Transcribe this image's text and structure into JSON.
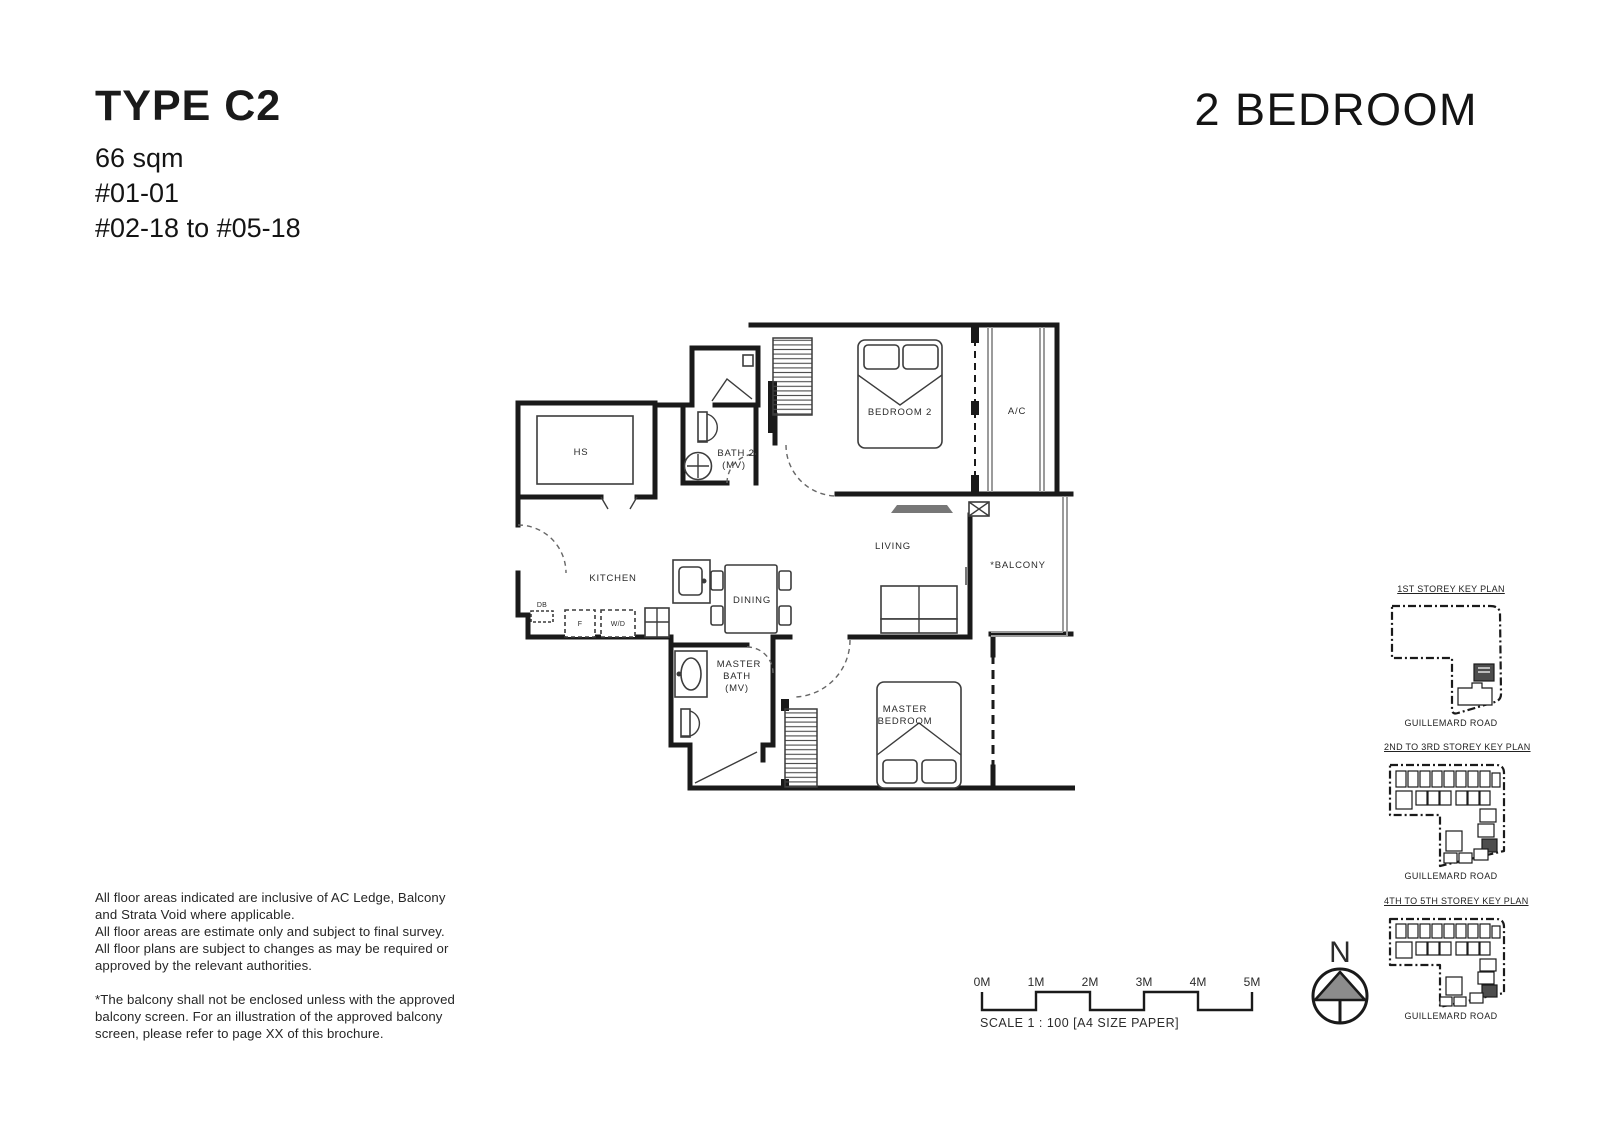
{
  "header": {
    "type_name": "TYPE C2",
    "area": "66 sqm",
    "units": [
      "#01-01",
      "#02-18 to #05-18"
    ],
    "category": "2 BEDROOM"
  },
  "plan": {
    "labels": {
      "hs": "HS",
      "bath2_l1": "BATH 2",
      "bath2_l2": "(MV)",
      "bedroom2": "BEDROOM 2",
      "ac": "A/C",
      "living": "LIVING",
      "balcony": "*BALCONY",
      "kitchen": "KITCHEN",
      "dining": "DINING",
      "mbath_l1": "MASTER",
      "mbath_l2": "BATH",
      "mbath_l3": "(MV)",
      "mbed_l1": "MASTER",
      "mbed_l2": "BEDROOM",
      "db": "DB",
      "f": "F",
      "wd": "W/D"
    }
  },
  "keyplans": [
    {
      "title": "1ST STOREY KEY PLAN",
      "caption": "GUILLEMARD ROAD"
    },
    {
      "title": "2ND TO 3RD STOREY KEY PLAN",
      "caption": "GUILLEMARD ROAD"
    },
    {
      "title": "4TH TO 5TH STOREY KEY PLAN",
      "caption": "GUILLEMARD ROAD"
    }
  ],
  "scale": {
    "ticks": [
      "0M",
      "1M",
      "2M",
      "3M",
      "4M",
      "5M"
    ],
    "caption": "SCALE  1 : 100 [A4 SIZE PAPER]"
  },
  "compass": {
    "label": "N"
  },
  "disclaimer": {
    "lines": [
      "All floor areas indicated are inclusive of AC Ledge, Balcony",
      "and Strata Void where applicable.",
      "All floor areas are estimate only and subject to final survey.",
      "All floor plans are subject to changes as may be required or",
      "approved by the relevant authorities.",
      "*The balcony shall not be enclosed unless with the approved",
      "balcony screen. For an illustration of the approved balcony",
      "screen, please refer to page XX of this brochure."
    ]
  }
}
